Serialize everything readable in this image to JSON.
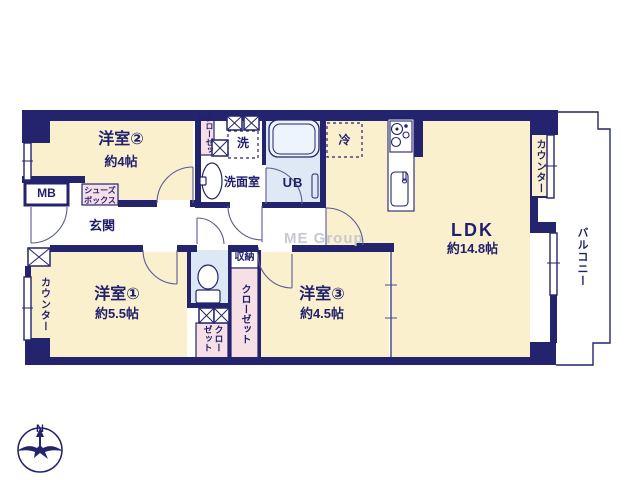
{
  "plan": {
    "type": "apartment-floor-plan",
    "watermark": "ME Group",
    "compass": {
      "north_label": "N"
    },
    "rooms": {
      "room2": {
        "name": "洋室②",
        "size": "約4帖"
      },
      "room1": {
        "name": "洋室①",
        "size": "約5.5帖"
      },
      "room3": {
        "name": "洋室③",
        "size": "約4.5帖"
      },
      "ldk": {
        "name": "LDK",
        "size": "約14.8帖"
      },
      "genkan": {
        "name": "玄関"
      },
      "washroom": {
        "name": "洗面室"
      },
      "bath": {
        "name": "UB"
      }
    },
    "fixtures": {
      "meter_box": "MB",
      "shoes_box_line1": "シューズ",
      "shoes_box_line2": "ボックス",
      "laundry": "洗",
      "fridge": "冷",
      "storage": "収納",
      "closet_top": "クローゼット",
      "closet_mid": "クローゼット",
      "closet_bottom": "クローゼット",
      "counter_left": "カウンター",
      "counter_right": "カウンター",
      "balcony": "バルコニー"
    },
    "colors": {
      "wall": "#24246e",
      "room_fill": "#faf0cd",
      "closet_fill": "#f7dfe6",
      "wet_area_fill": "#dfe9f5",
      "text": "#1f1f6e",
      "watermark": "#c6c6ce"
    }
  }
}
